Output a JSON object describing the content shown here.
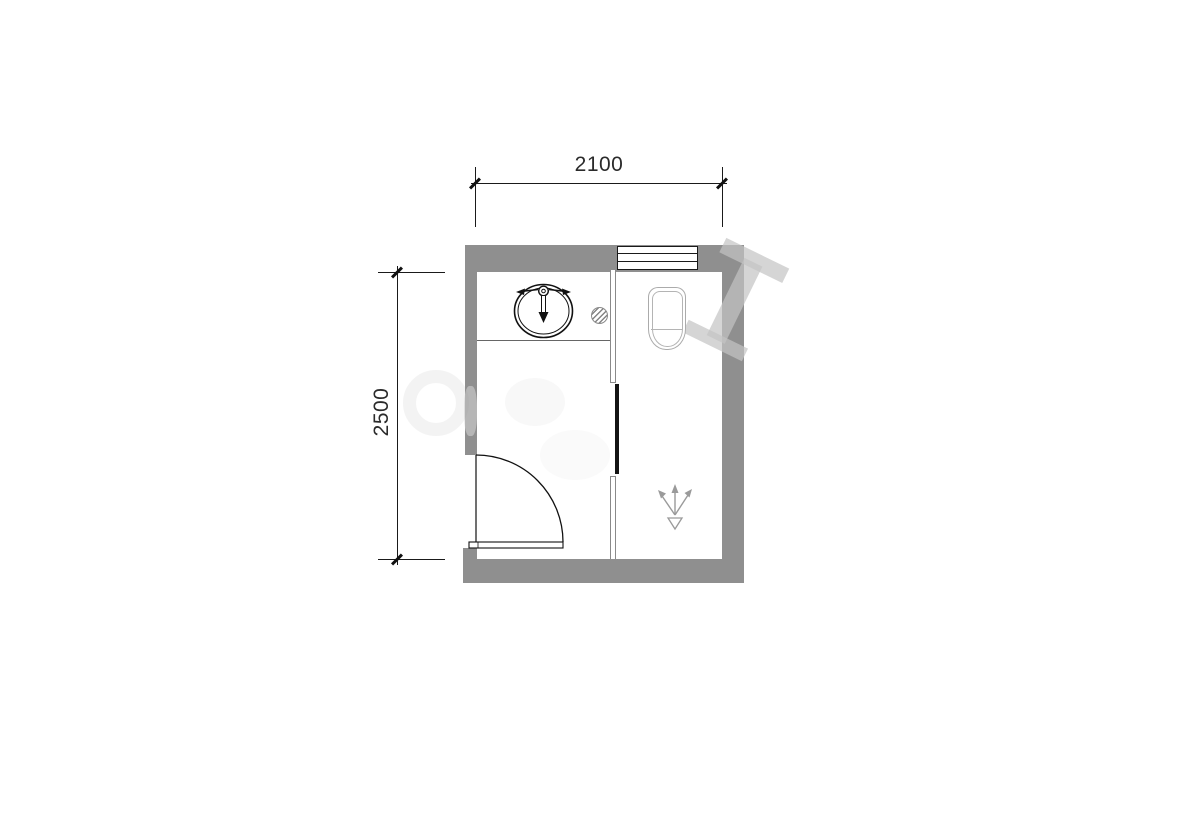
{
  "dimensions": {
    "top": {
      "label": "2100"
    },
    "left": {
      "label": "2500"
    }
  },
  "colors": {
    "background": "#ffffff",
    "wall": "#8f8f8f",
    "line": "#1a1a1a",
    "partition": "#8a8a8a",
    "counter": "#666666",
    "fixture": "#ababab",
    "symbol": "#9a9a9a",
    "dim_text": "#2b2b2b",
    "watermark": "rgba(195,195,195,0.7)"
  },
  "fixtures": {
    "sink": "round-washbasin-with-faucet",
    "toilet": "squat-toilet",
    "floor_drain": "hatched-floor-drain",
    "door": "single-swing-door",
    "shower": "shower-spray-symbol",
    "window": "three-line-window"
  }
}
